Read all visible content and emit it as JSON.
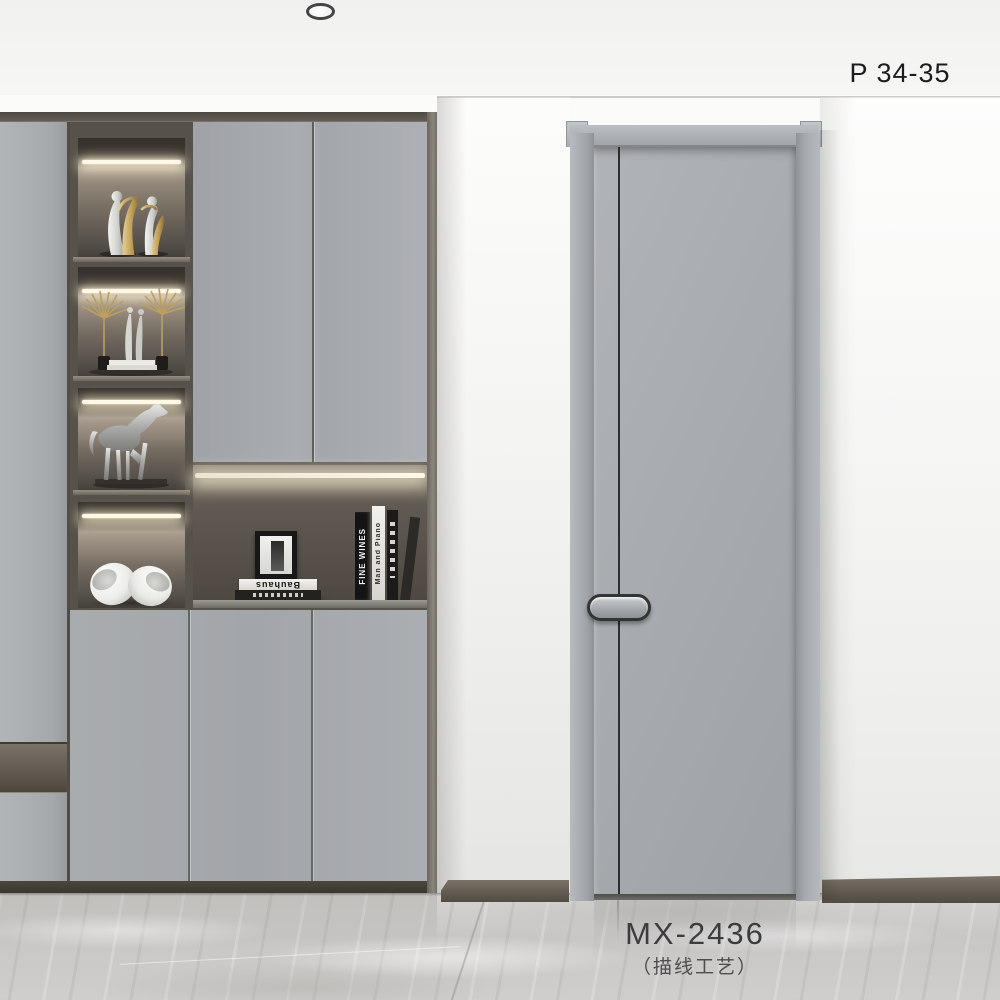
{
  "labels": {
    "page_ref": "P 34-35",
    "model_code": "MX-2436",
    "model_note": "（描线工艺）"
  },
  "decor": {
    "book_stack_title": "Bauhaus",
    "book_spine_1": "FINE WINES",
    "book_spine_2": "Man and Piano"
  },
  "colors": {
    "wall": "#f5f5f3",
    "ceiling": "#f2f2f0",
    "cabinet_gray": "#a6a9ad",
    "cabinet_frame": "#5d584f",
    "niche_dark": "#46413b",
    "led_warm": "#fff8e6",
    "door_gray": "#a7abaf",
    "door_line": "#2e2e2e",
    "baseboard": "#5d564c",
    "floor_marble": "#cbcac8",
    "gold": "#c2a35e",
    "silver": "#d8d8d6",
    "text_dark": "#1c1c1c"
  }
}
